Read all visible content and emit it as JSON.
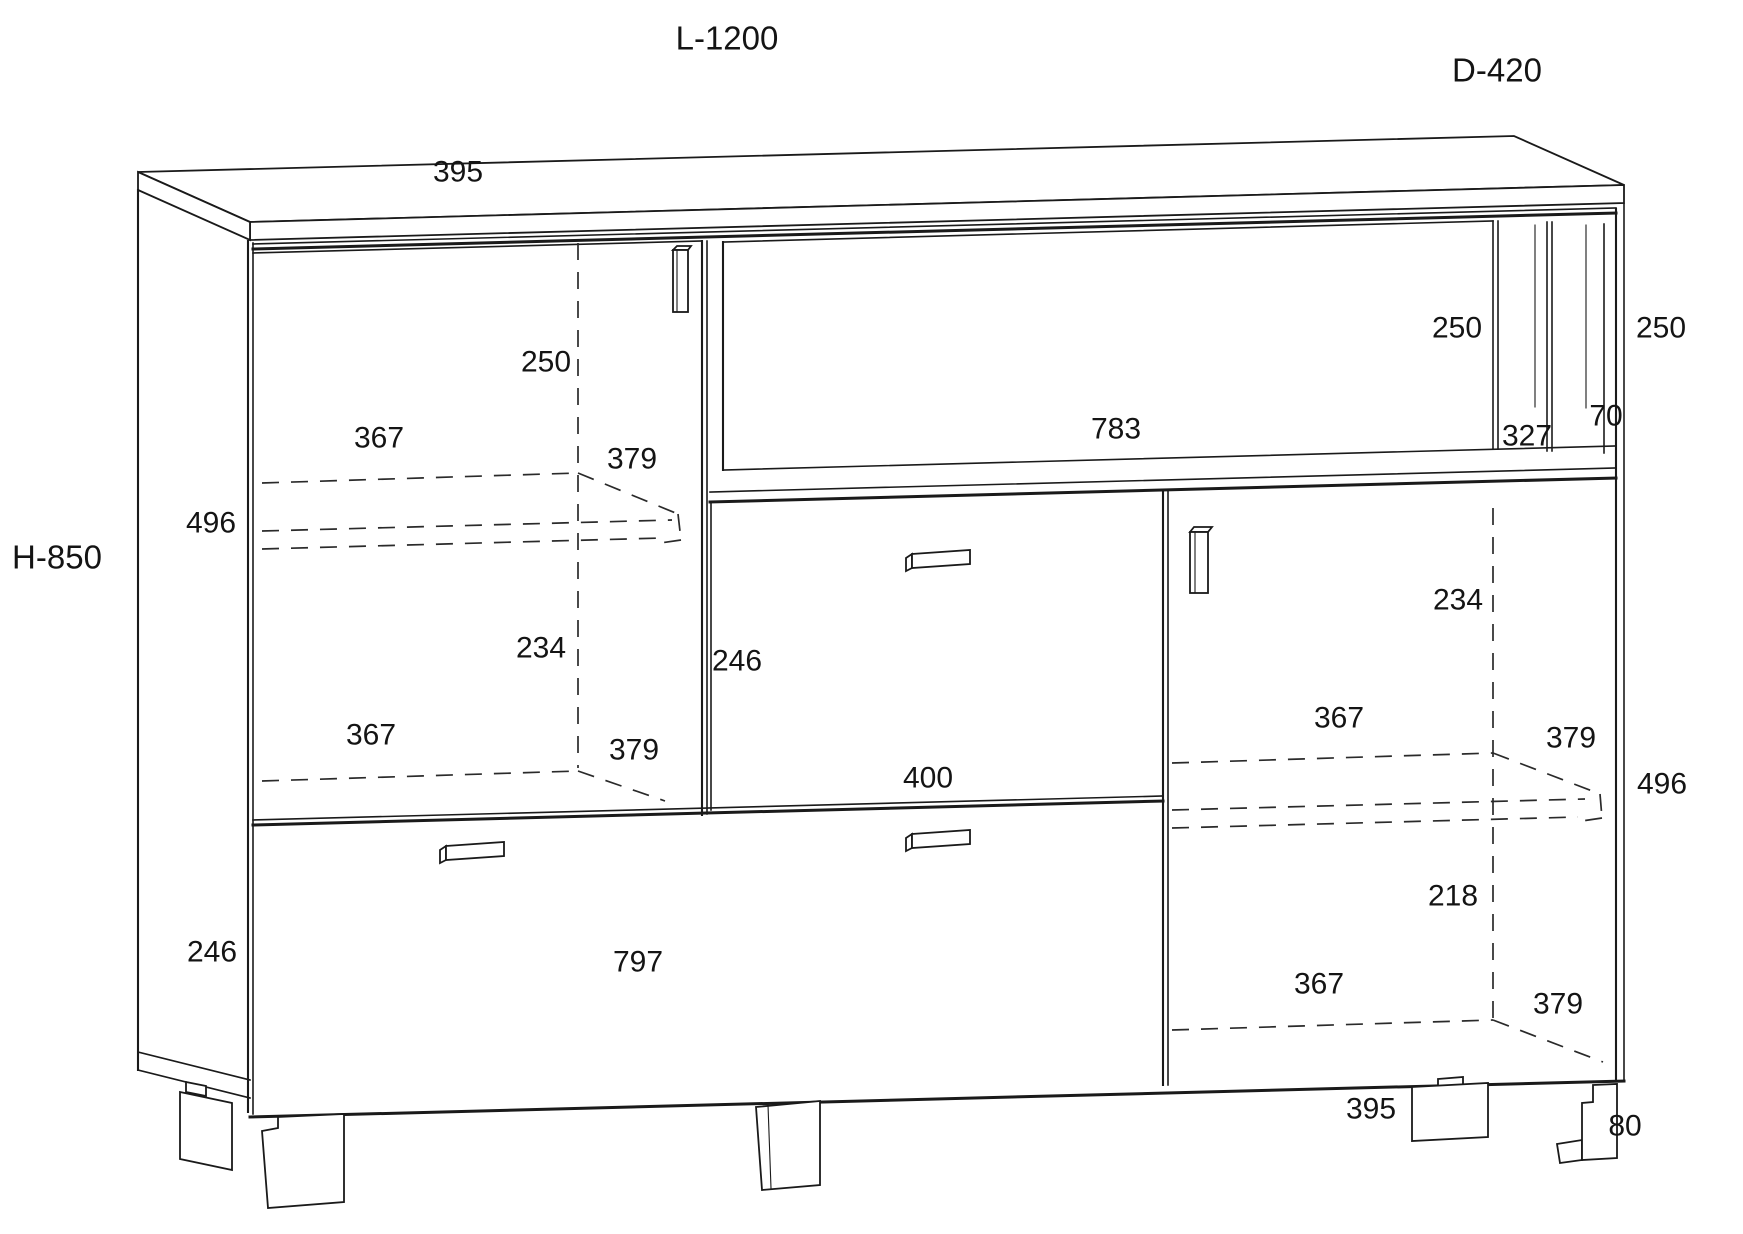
{
  "colors": {
    "line": "#1a1a1a",
    "background": "#ffffff"
  },
  "diagram": {
    "type": "furniture-technical-drawing",
    "overall": {
      "length": "L-1200",
      "depth": "D-420",
      "height": "H-850"
    },
    "labels": [
      {
        "id": "overall-length",
        "text": "L-1200",
        "x": 727,
        "y": 38,
        "size": "lg"
      },
      {
        "id": "overall-depth",
        "text": "D-420",
        "x": 1497,
        "y": 70,
        "size": "lg"
      },
      {
        "id": "overall-height",
        "text": "H-850",
        "x": 57,
        "y": 557,
        "size": "lg"
      },
      {
        "id": "top-panel-width-395",
        "text": "395",
        "x": 458,
        "y": 172
      },
      {
        "id": "left-door-upper-250",
        "text": "250",
        "x": 546,
        "y": 362
      },
      {
        "id": "left-shelf-width-367",
        "text": "367",
        "x": 379,
        "y": 438
      },
      {
        "id": "left-shelf-depth-379",
        "text": "379",
        "x": 632,
        "y": 459
      },
      {
        "id": "left-door-height-496",
        "text": "496",
        "x": 211,
        "y": 523
      },
      {
        "id": "left-lower-height-234",
        "text": "234",
        "x": 541,
        "y": 648
      },
      {
        "id": "left-lower-width-367",
        "text": "367",
        "x": 371,
        "y": 735
      },
      {
        "id": "left-lower-depth-379",
        "text": "379",
        "x": 634,
        "y": 750
      },
      {
        "id": "left-drawer-height-246",
        "text": "246",
        "x": 212,
        "y": 952
      },
      {
        "id": "niche-width-783",
        "text": "783",
        "x": 1116,
        "y": 429
      },
      {
        "id": "niche-height-250",
        "text": "250",
        "x": 1457,
        "y": 328
      },
      {
        "id": "right-side-height-250",
        "text": "250",
        "x": 1661,
        "y": 328
      },
      {
        "id": "niche-inner-width-327",
        "text": "327",
        "x": 1527,
        "y": 436
      },
      {
        "id": "niche-frame-70",
        "text": "70",
        "x": 1606,
        "y": 416
      },
      {
        "id": "flap-height-246",
        "text": "246",
        "x": 737,
        "y": 661
      },
      {
        "id": "flap-width-400",
        "text": "400",
        "x": 928,
        "y": 778
      },
      {
        "id": "right-upper-height-234",
        "text": "234",
        "x": 1458,
        "y": 600
      },
      {
        "id": "right-shelf-width-367",
        "text": "367",
        "x": 1339,
        "y": 718
      },
      {
        "id": "right-shelf-depth-379",
        "text": "379",
        "x": 1571,
        "y": 738
      },
      {
        "id": "right-door-height-496",
        "text": "496",
        "x": 1662,
        "y": 784
      },
      {
        "id": "right-lower-height-218",
        "text": "218",
        "x": 1453,
        "y": 896
      },
      {
        "id": "right-lower-width-367",
        "text": "367",
        "x": 1319,
        "y": 984
      },
      {
        "id": "right-lower-depth-379",
        "text": "379",
        "x": 1558,
        "y": 1004
      },
      {
        "id": "drawer-width-797",
        "text": "797",
        "x": 638,
        "y": 962
      },
      {
        "id": "right-door-width-395",
        "text": "395",
        "x": 1371,
        "y": 1109
      },
      {
        "id": "leg-height-80",
        "text": "80",
        "x": 1625,
        "y": 1126
      }
    ]
  }
}
